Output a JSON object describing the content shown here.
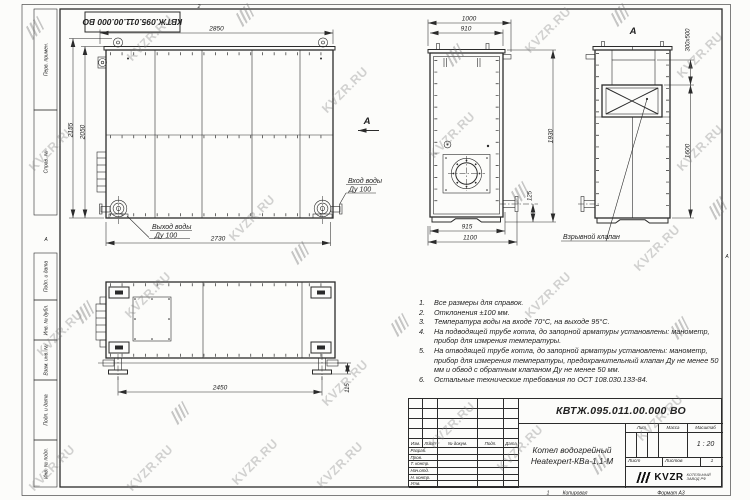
{
  "sheet": {
    "doc_number": "КВТЖ.095.011.00.000 ВО",
    "zone_top": "2",
    "zone_bottom": "1",
    "zone_left": "А",
    "zone_right": "А",
    "copied_label": "Копировал",
    "format_label": "Формат А3"
  },
  "frame_labels": {
    "perv_primen": "Перв. примен.",
    "sprav_no": "Справ. №",
    "podp_data_1": "Подп. и дата",
    "inv_dubl": "Инв. № дубл.",
    "vzam_inv": "Взам. инв. №",
    "podp_data_2": "Подп. и дата",
    "inv_podl": "Инв. № подл."
  },
  "views": {
    "front": {
      "dim_top": "2850",
      "dim_left_outer": "2155",
      "dim_left_inner": "2050",
      "dim_bottom": "2730",
      "outlet_label": "Выход воды",
      "outlet_dn": "Ду 100",
      "inlet_label": "Вход воды",
      "inlet_dn": "Ду 100",
      "section_arrow": "А"
    },
    "side": {
      "dim_top_outer": "1000",
      "dim_top_inner": "910",
      "dim_right": "1930",
      "dim_flange": "125",
      "dim_bottom_inner": "915",
      "dim_bottom_outer": "1100"
    },
    "view_a": {
      "label": "А",
      "dim_opening": "300x500",
      "dim_height": "1600",
      "callout": "Взрывной клапан"
    },
    "plan": {
      "dim_length": "2450",
      "dim_foot": "115"
    }
  },
  "notes": [
    {
      "num": "1.",
      "text": "Все размеры для справок."
    },
    {
      "num": "2.",
      "text": "Отклонения ±100 мм."
    },
    {
      "num": "3.",
      "text": "Температура воды на входе 70°С, на выходе 95°С."
    },
    {
      "num": "4.",
      "text": "На подводящей трубе котла, до запорной арматуры установлены: манометр, прибор для измрения температуры."
    },
    {
      "num": "5.",
      "text": "На отводящей трубе котла, до запорной арматуры установлены: манометр, прибор для измерения температуры, предохранительный клапан Ду не менее 50 мм и обвод с обратным клапаном Ду не менее 50 мм."
    },
    {
      "num": "6.",
      "text": "Остальные технические требования по ОСТ 108.030.133-84."
    }
  ],
  "title_block": {
    "designation": "КВТЖ.095.011.00.000 ВО",
    "name_line1": "Котел водогрейный",
    "name_line2": "Heatexpert-КВа-1,1-М",
    "rev_headers": [
      "Изм.",
      "Лист",
      "№ докум.",
      "Подп.",
      "Дата"
    ],
    "sig_rows": [
      "Разраб.",
      "Пров.",
      "Т. контр.",
      "Нач.отд.",
      "Н. контр.",
      "Утв."
    ],
    "lit_label": "Лит.",
    "mass_label": "Масса",
    "scale_label": "Масштаб",
    "scale_value": "1 : 20",
    "sheet_label": "Лист",
    "sheets_label": "Листов",
    "sheets_value": "1",
    "logo_text": "KVZR",
    "logo_caption1": "КОТЕЛЬНЫЙ",
    "logo_caption2": "ЗАВОД РФ"
  },
  "watermark_text": "KVZR.RU",
  "watermarks": [
    {
      "x": 150,
      "y": 38,
      "t": "text"
    },
    {
      "x": 345,
      "y": 90,
      "t": "text"
    },
    {
      "x": 548,
      "y": 30,
      "t": "text"
    },
    {
      "x": 700,
      "y": 148,
      "t": "text"
    },
    {
      "x": 52,
      "y": 148,
      "t": "text"
    },
    {
      "x": 252,
      "y": 218,
      "t": "text"
    },
    {
      "x": 452,
      "y": 135,
      "t": "text"
    },
    {
      "x": 657,
      "y": 248,
      "t": "text"
    },
    {
      "x": 148,
      "y": 295,
      "t": "text"
    },
    {
      "x": 60,
      "y": 333,
      "t": "text"
    },
    {
      "x": 345,
      "y": 383,
      "t": "text"
    },
    {
      "x": 548,
      "y": 295,
      "t": "text"
    },
    {
      "x": 255,
      "y": 462,
      "t": "text"
    },
    {
      "x": 452,
      "y": 425,
      "t": "text"
    },
    {
      "x": 660,
      "y": 418,
      "t": "text"
    },
    {
      "x": 52,
      "y": 468,
      "t": "text"
    },
    {
      "x": 340,
      "y": 465,
      "t": "text"
    },
    {
      "x": 700,
      "y": 55,
      "t": "text"
    },
    {
      "x": 520,
      "y": 448,
      "t": "text"
    },
    {
      "x": 150,
      "y": 468,
      "t": "text"
    },
    {
      "x": 245,
      "y": 15,
      "t": "logo"
    },
    {
      "x": 455,
      "y": 55,
      "t": "logo"
    },
    {
      "x": 620,
      "y": 15,
      "t": "logo"
    },
    {
      "x": 85,
      "y": 312,
      "t": "logo"
    },
    {
      "x": 300,
      "y": 253,
      "t": "logo"
    },
    {
      "x": 520,
      "y": 193,
      "t": "logo"
    },
    {
      "x": 680,
      "y": 328,
      "t": "logo"
    },
    {
      "x": 180,
      "y": 413,
      "t": "logo"
    },
    {
      "x": 400,
      "y": 325,
      "t": "logo"
    },
    {
      "x": 600,
      "y": 463,
      "t": "logo"
    },
    {
      "x": 35,
      "y": 28,
      "t": "logo"
    },
    {
      "x": 718,
      "y": 208,
      "t": "logo"
    }
  ]
}
